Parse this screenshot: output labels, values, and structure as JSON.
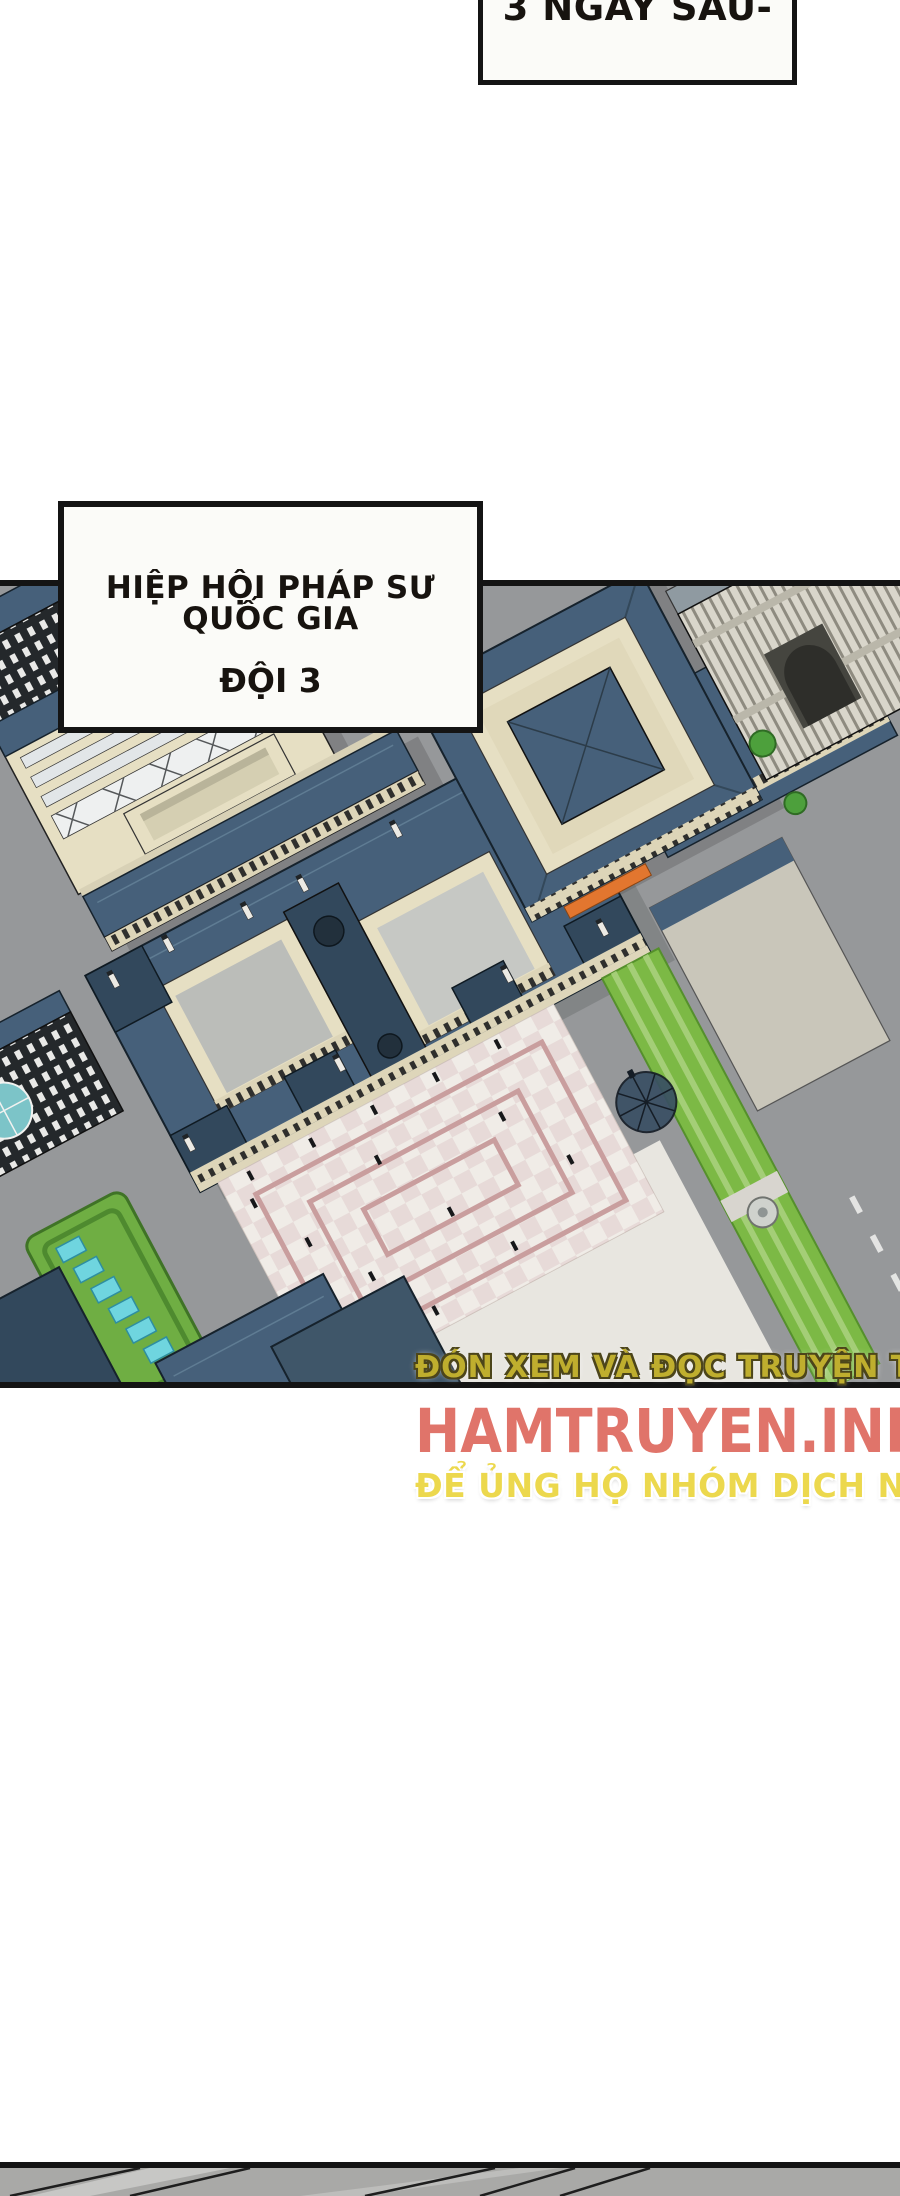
{
  "captions": {
    "time_skip": "3 NGÀY SAU-",
    "guild_line1": "HIỆP HỘI PHÁP SƯ QUỐC GIA",
    "guild_line2": "ĐỘI 3"
  },
  "watermark": {
    "promo_top": "ĐÓN XEM VÀ ĐỌC TRUYỆN TẠI",
    "site_name": "HAMTRUYEN.INFO",
    "promo_bottom": "ĐỂ ỦNG HỘ NHÓM DỊCH NHÉ"
  },
  "illustration": {
    "name": "palace-city-aerial-view"
  },
  "theme": {
    "page_bg": "#ffffff",
    "ink": "#141414",
    "caption_bg": "#fbfbf8",
    "caption_text": "#17130f",
    "street_gray": "#96989a",
    "pavement_light": "#e8e6e0",
    "roof_slate": "#46607a",
    "roof_dark": "#32485c",
    "wall_cream": "#e6dfc3",
    "courtyard_floor": "#bbbdb9",
    "plaza_white": "#f0ece7",
    "plaza_pink": "#c99e9e",
    "garden_green": "#7cb945",
    "parterre_green": "#6fae43",
    "pool_cyan": "#6fd5df",
    "awning_orange": "#e2762f",
    "tree_green": "#4da03c",
    "shadow_gray": "#5e6062",
    "wm_yellow": "#bfae2e",
    "wm_yellow_outline": "#4c451a",
    "wm_salmon": "#e0746a",
    "wm_gold": "#ecd84d",
    "next_panel_gray": "#a9a9a7"
  }
}
